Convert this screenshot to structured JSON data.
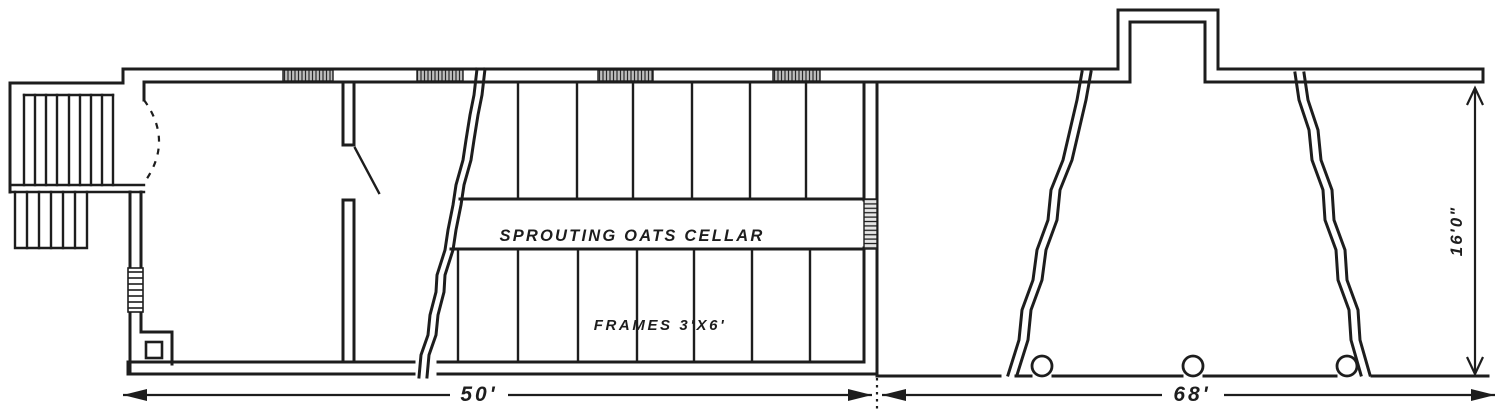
{
  "plan": {
    "labels": {
      "cellar": "SPROUTING OATS CELLAR",
      "frames": "FRAMES 3'X6'"
    },
    "dimensions": {
      "left_section_width": "50'",
      "right_section_width": "68'",
      "height": "16'0\""
    },
    "colors": {
      "ink": "#1d1d1d",
      "paper": "#ffffff",
      "window_hatch": "#bfbfbf"
    }
  }
}
